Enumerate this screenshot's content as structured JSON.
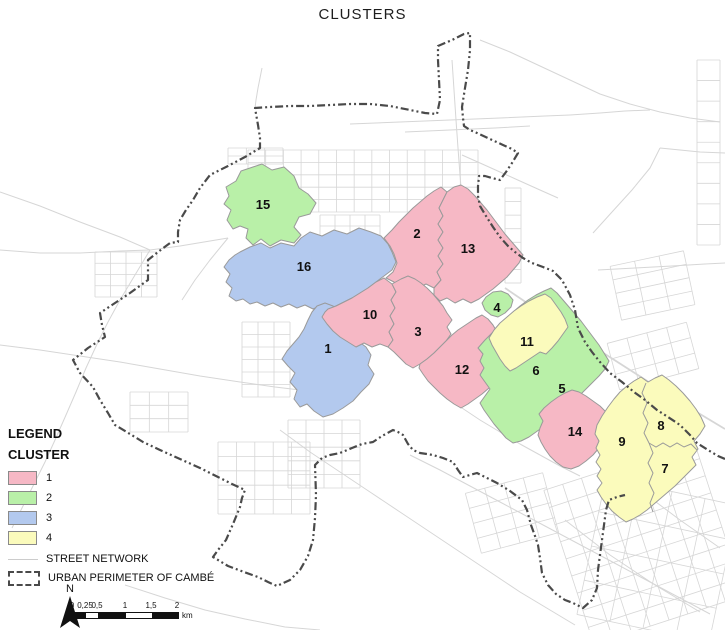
{
  "title": "CLUSTERS",
  "colors": {
    "street": "#d6d6d6",
    "cluster_border": "#9a9a9a",
    "perimeter": "#4a4a4a",
    "text": "#111111"
  },
  "legend": {
    "title": "LEGEND",
    "subtitle": "CLUSTER",
    "items": [
      {
        "label": "1",
        "color": "#f6b8c5"
      },
      {
        "label": "2",
        "color": "#b9f0a8"
      },
      {
        "label": "3",
        "color": "#b3c9ee"
      },
      {
        "label": "4",
        "color": "#fbfbbc"
      }
    ],
    "street_label": "STREET NETWORK",
    "perimeter_label": "URBAN PERIMETER OF CAMBÉ"
  },
  "scalebar": {
    "tick_labels": [
      "0",
      "0,25",
      "0,5",
      "1",
      "1,5",
      "2"
    ],
    "tick_positions": [
      6,
      19,
      31,
      59,
      85,
      111
    ],
    "segments": [
      {
        "w": 13,
        "fill": "#111111"
      },
      {
        "w": 12,
        "fill": "#ffffff"
      },
      {
        "w": 28,
        "fill": "#111111"
      },
      {
        "w": 26,
        "fill": "#ffffff"
      },
      {
        "w": 26,
        "fill": "#111111"
      }
    ],
    "unit": "km"
  },
  "north": {
    "label": "N",
    "x": 70,
    "y": 592,
    "arrow": "70,596 60,628 70,621 80,628"
  },
  "map": {
    "group_colors": {
      "1": "#f6b8c5",
      "2": "#b9f0a8",
      "3": "#b3c9ee",
      "4": "#fbfbbc"
    },
    "clusters": [
      {
        "id": "15",
        "group": "2",
        "lx": 263,
        "ly": 209,
        "points": "250,168 262,164 272,170 284,167 294,176 299,188 308,194 316,203 310,214 299,217 294,227 301,235 294,243 281,240 270,246 261,239 253,245 246,238 248,229 240,226 233,229 227,220 231,210 224,204 229,196 226,187 236,181 241,171"
      },
      {
        "id": "16",
        "group": "3",
        "lx": 304,
        "ly": 271,
        "points": "240,252 250,247 261,243 270,248 281,243 294,246 301,238 310,232 322,236 334,230 347,234 359,228 371,232 381,236 388,244 392,252 396,262 392,270 384,276 376,282 368,288 360,293 352,298 344,302 336,306 328,309 320,306 313,309 305,305 297,308 289,304 281,307 273,303 265,306 257,302 250,304 243,299 236,301 229,296 232,288 226,282 230,274 224,267 229,260 235,255"
      },
      {
        "id": "1",
        "group": "3",
        "lx": 328,
        "ly": 353,
        "points": "317,306 325,303 333,306 340,310 346,317 342,326 350,334 358,341 366,347 371,355 368,365 374,374 369,384 361,392 353,401 343,408 333,414 323,417 314,411 307,404 300,407 294,399 297,390 290,382 295,373 288,366 282,359 287,351 293,344 299,337 304,329 308,320 312,312"
      },
      {
        "id": "2",
        "group": "1",
        "lx": 417,
        "ly": 238,
        "points": "384,238 392,230 399,222 406,215 413,208 420,202 427,196 434,191 441,187 447,192 443,200 439,208 443,216 438,224 443,232 438,240 443,248 438,256 443,264 437,272 441,280 434,288 426,284 418,288 410,283 402,287 394,282 386,278 393,272 397,263 394,254 390,246"
      },
      {
        "id": "13",
        "group": "1",
        "lx": 468,
        "ly": 253,
        "points": "447,192 454,187 461,185 468,189 475,196 481,203 487,210 493,218 499,226 505,234 511,241 517,248 523,255 519,263 513,270 507,277 500,283 493,289 486,294 479,299 471,303 463,299 455,303 447,298 440,301 434,295 434,288 441,280 437,272 443,264 438,256 443,248 438,240 443,232 438,224 443,216 439,208 443,200"
      },
      {
        "id": "10",
        "group": "1",
        "lx": 370,
        "ly": 319,
        "points": "328,309 336,306 344,302 352,298 360,293 368,288 376,282 384,278 392,284 396,292 391,300 395,308 390,316 394,324 389,332 393,340 388,347 380,344 372,347 364,343 356,347 348,342 340,337 333,331 327,324 322,317 325,312"
      },
      {
        "id": "3",
        "group": "1",
        "lx": 418,
        "ly": 336,
        "points": "392,284 401,279 408,276 415,279 421,283 427,288 433,294 438,300 443,306 447,313 452,320 447,327 451,334 446,341 440,347 434,353 427,359 420,364 413,368 406,364 400,358 394,352 388,347 393,340 389,332 394,324 390,316 395,308 391,300 396,292"
      },
      {
        "id": "12",
        "group": "1",
        "lx": 462,
        "ly": 374,
        "points": "420,364 427,359 434,353 440,347 446,341 452,335 458,330 464,326 470,322 476,318 482,315 488,319 493,325 497,332 501,339 505,346 509,353 512,360 507,367 501,374 495,381 489,388 482,394 475,399 468,404 461,408 454,404 447,399 440,393 434,387 428,381 423,374 419,368"
      },
      {
        "id": "4",
        "group": "2",
        "lx": 497,
        "ly": 312,
        "points": "486,297 493,292 501,291 508,294 513,300 511,307 505,313 498,317 491,315 485,310 482,303"
      },
      {
        "id": "5",
        "group": "2",
        "lx": 562,
        "ly": 393,
        "points": "478,348 485,340 492,333 499,326 506,319 513,312 520,306 528,300 536,295 544,291 551,288 557,293 563,300 569,307 575,314 581,321 587,329 593,337 599,345 604,353 609,361 605,369 599,376 592,383 585,390 578,397 571,403 564,409 557,415 550,421 543,427 536,432 529,437 521,441 513,443 506,438 500,431 494,424 489,417 484,410 480,403 485,396 490,389 485,382 480,375 484,368 480,361 483,354"
      },
      {
        "id": "11",
        "group": "4",
        "lx": 527,
        "ly": 346,
        "points": "494,330 500,323 507,317 514,311 521,306 529,301 537,297 545,294 551,298 556,305 561,312 565,319 568,327 563,334 558,341 552,348 546,354 540,352 534,356 528,360 522,364 516,368 510,371 505,366 500,359 496,352 492,345 489,338"
      },
      {
        "id": "6",
        "group": "2",
        "lx": 536,
        "ly": 375,
        "points": ""
      },
      {
        "id": "14",
        "group": "1",
        "lx": 575,
        "ly": 436,
        "points": "544,408 551,402 558,397 565,393 572,390 579,392 586,396 593,401 600,406 606,412 611,419 614,426 610,434 605,441 599,448 593,455 586,461 579,466 571,469 563,467 556,462 550,456 545,449 541,442 538,435 540,428 543,421 539,414"
      },
      {
        "id": "9",
        "group": "4",
        "lx": 622,
        "ly": 446,
        "points": "597,425 602,416 608,407 614,399 620,392 627,386 634,381 641,377 648,382 655,378 662,375 669,380 676,386 683,393 690,401 696,409 701,417 705,426 700,434 694,441 698,449 692,457 696,465 689,472 682,479 675,486 668,492 661,498 654,504 647,510 640,515 633,519 626,522 619,517 612,511 606,504 601,497 597,490 602,483 597,476 601,469 596,462 600,455 596,448 599,441 595,434"
      },
      {
        "id": "8",
        "group": "4",
        "lx": 661,
        "ly": 430,
        "points": ""
      },
      {
        "id": "7",
        "group": "4",
        "lx": 665,
        "ly": 473,
        "points": ""
      }
    ],
    "dividers": [
      "646,383 642,393 647,403 643,413 648,423 644,433 649,443",
      "649,443 656,447 663,443 670,447 677,443 684,447 691,444 697,450",
      "649,443 653,453 648,463 653,473 649,483 654,493 650,503 653,512"
    ],
    "streets": [
      {
        "p": "262,68 258,88 256,100 255,108"
      },
      {
        "p": "0,250 40,253 80,253 120,251 150,250 180,246 210,241 228,238"
      },
      {
        "p": "150,250 135,275 120,300 108,322 98,342 86,368 76,392 66,415 55,440 45,462 34,484 22,508 12,528"
      },
      {
        "p": "0,345 40,350 80,356 120,362 160,369 200,376 240,382 275,387 300,390"
      },
      {
        "p": "280,430 310,452 340,472 370,492 400,512 430,532 460,552 490,572 520,592 550,610 575,625"
      },
      {
        "p": "410,455 440,470 470,486 500,502 530,518 560,534 590,550 620,566 650,582 680,598 710,614"
      },
      {
        "p": "505,288 530,305 555,322 580,338 605,354 630,370 655,386 680,402 705,417 725,429",
        "w": 1.8
      },
      {
        "p": "452,60 454,90 456,120 458,148 460,175 462,200"
      },
      {
        "p": "350,124 400,122 450,120 500,118 545,116 570,115"
      },
      {
        "p": "405,132 450,130 495,128 530,126"
      },
      {
        "p": "462,155 480,163 500,172 520,181 540,190 558,198"
      },
      {
        "p": "0,192 40,206 80,222 120,237 150,250"
      },
      {
        "p": "125,585 165,598 205,610 245,619 285,627 320,630"
      },
      {
        "p": "593,233 612,212 632,190 650,168 660,148"
      },
      {
        "p": "598,270 635,268 672,266 705,264 725,263"
      },
      {
        "p": "228,238 210,260 195,280 182,300"
      },
      {
        "p": "480,40 510,52 540,66 570,80 600,94 630,104 660,112 690,118 720,122"
      },
      {
        "p": "462,408 480,420 500,432 520,444 540,455"
      },
      {
        "p": "540,455 560,466 580,476"
      },
      {
        "p": "660,148 680,150 700,152 725,153"
      },
      {
        "p": "570,115 600,113 625,111 650,110"
      },
      {
        "p": "600,460 640,490 680,520 720,548"
      },
      {
        "p": "565,520 610,555 655,585 700,612"
      }
    ],
    "grids": [
      {
        "x": 248,
        "y": 150,
        "w": 230,
        "h": 62,
        "rows": 5,
        "cols": 13,
        "a": 0
      },
      {
        "x": 228,
        "y": 148,
        "w": 55,
        "h": 16,
        "rows": 2,
        "cols": 3,
        "a": 0
      },
      {
        "x": 95,
        "y": 252,
        "w": 62,
        "h": 45,
        "rows": 4,
        "cols": 4,
        "a": 0
      },
      {
        "x": 130,
        "y": 392,
        "w": 58,
        "h": 40,
        "rows": 3,
        "cols": 3,
        "a": 0
      },
      {
        "x": 218,
        "y": 442,
        "w": 92,
        "h": 72,
        "rows": 5,
        "cols": 5,
        "a": 0
      },
      {
        "x": 288,
        "y": 420,
        "w": 72,
        "h": 68,
        "rows": 5,
        "cols": 4,
        "a": 0
      },
      {
        "x": 565,
        "y": 462,
        "w": 158,
        "h": 162,
        "rows": 9,
        "cols": 8,
        "a": -18
      },
      {
        "x": 590,
        "y": 490,
        "w": 135,
        "h": 140,
        "rows": 4,
        "cols": 4,
        "a": 12
      },
      {
        "x": 615,
        "y": 258,
        "w": 75,
        "h": 55,
        "rows": 4,
        "cols": 3,
        "a": -12
      },
      {
        "x": 472,
        "y": 482,
        "w": 80,
        "h": 62,
        "rows": 4,
        "cols": 4,
        "a": -15
      },
      {
        "x": 612,
        "y": 332,
        "w": 82,
        "h": 48,
        "rows": 3,
        "cols": 4,
        "a": -15
      },
      {
        "x": 697,
        "y": 60,
        "w": 23,
        "h": 185,
        "rows": 9,
        "cols": 1,
        "a": 0
      },
      {
        "x": 505,
        "y": 188,
        "w": 16,
        "h": 95,
        "rows": 7,
        "cols": 1,
        "a": 0
      },
      {
        "x": 242,
        "y": 322,
        "w": 48,
        "h": 75,
        "rows": 6,
        "cols": 3,
        "a": 0
      },
      {
        "x": 320,
        "y": 215,
        "w": 60,
        "h": 22,
        "rows": 2,
        "cols": 4,
        "a": 0
      }
    ],
    "perimeter": "725,459 718,456 708,450 697,443 690,435 680,425 668,417 657,410 645,400 634,392 622,382 610,373 600,362 592,352 585,342 578,328 575,310 570,295 562,280 553,271 543,267 532,263 523,258 515,252 508,246 500,237 493,227 486,216 480,206 478,196 478,186 479,176 485,176 492,178 500,180 506,172 512,163 518,153 512,149 503,145 490,139 477,133 470,130 464,126 463,118 462,107 465,88 468,70 470,50 470,33 464,34 452,40 438,46 438,60 439,80 440,100 437,114 425,113 410,110 390,106 370,104 350,104 330,105 310,106 290,106 270,107 255,108 258,125 260,138 260,148 245,157 228,166 210,175 200,188 193,200 186,210 180,220 178,232 178,242 170,243 158,252 148,260 148,270 148,280 130,293 112,305 100,313 102,325 105,337 88,348 73,360 80,373 93,387 100,400 108,413 115,425 130,434 143,442 160,450 180,459 200,468 218,477 232,484 245,490 242,498 240,507 233,524 226,540 218,550 213,557 228,566 244,572 258,577 268,582 277,586 290,580 300,570 308,556 313,540 315,518 316,495 315,465 322,458 330,455 340,453 352,448 362,444 373,442 382,436 393,430 398,432 403,435 408,444 413,450 420,453 427,454 433,455 443,458 453,462 458,470 463,477 470,475 477,473 487,478 497,483 510,491 522,500 527,510 531,525 535,536 538,545 540,558 542,573 548,585 556,594 565,600 573,603 583,608 592,600 597,588 598,570 600,555 602,540 604,525 606,510 609,500 617,497 625,495"
  }
}
